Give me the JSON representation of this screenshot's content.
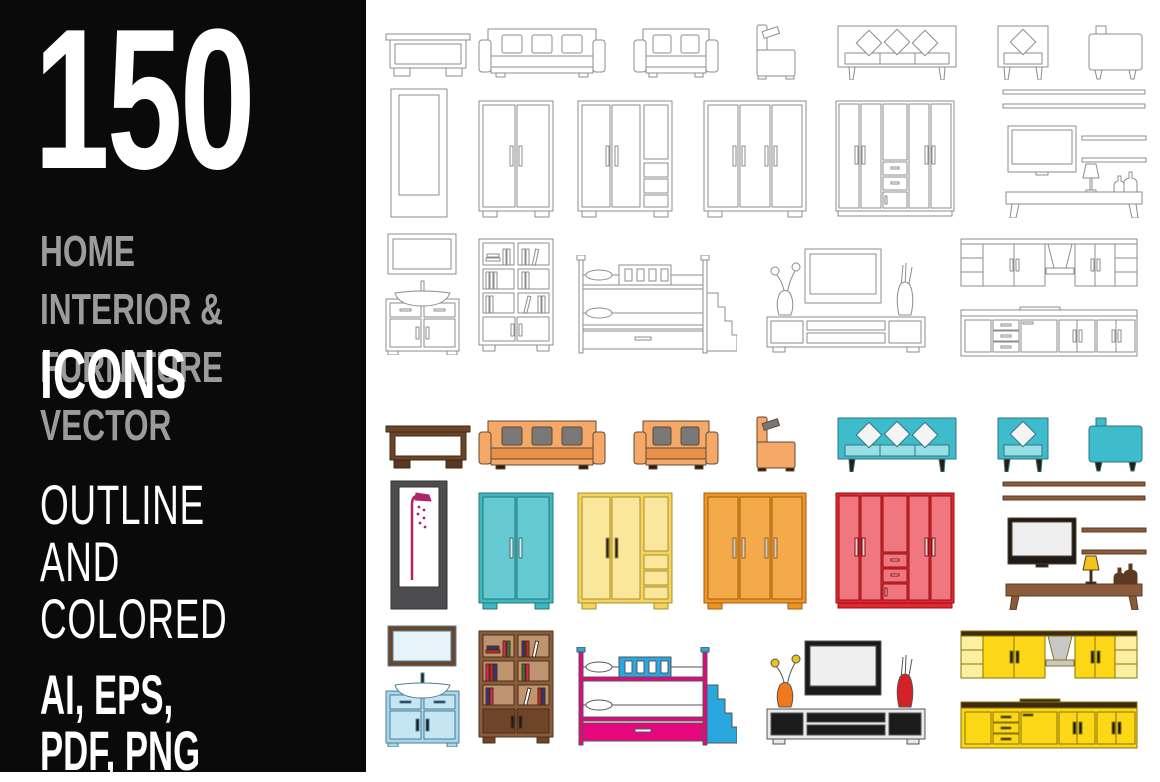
{
  "banner": {
    "count": "150",
    "line1": "HOME INTERIOR &",
    "line2": "FURNITURE VECTOR",
    "line3": "ICONS",
    "sub1": "OUTLINE AND",
    "sub2": "COLORED",
    "formats": "AI, EPS, PDF, PNG",
    "background": "#0a0a0a",
    "gray_text": "#9b9b9b",
    "white_text": "#ffffff"
  },
  "icon_grid": {
    "variants": [
      "outline",
      "colored"
    ],
    "colored_offset_y": 392,
    "icons": [
      {
        "id": "coffee-table",
        "label": "coffee table",
        "x": 385,
        "y": 33,
        "w": 86,
        "h": 45
      },
      {
        "id": "sofa-three-seat",
        "label": "three-seat sofa",
        "x": 478,
        "y": 28,
        "w": 128,
        "h": 50
      },
      {
        "id": "sofa-two-seat",
        "label": "two-seat sofa",
        "x": 633,
        "y": 28,
        "w": 86,
        "h": 50
      },
      {
        "id": "armchair-side",
        "label": "armchair side view",
        "x": 753,
        "y": 24,
        "w": 46,
        "h": 56
      },
      {
        "id": "sofa-diamond-pillows",
        "label": "sofa with diamond pillows",
        "x": 833,
        "y": 25,
        "w": 128,
        "h": 55
      },
      {
        "id": "loveseat-diamond-pillow",
        "label": "armchair with diamond pillow",
        "x": 995,
        "y": 25,
        "w": 56,
        "h": 55
      },
      {
        "id": "club-chair",
        "label": "club chair",
        "x": 1088,
        "y": 25,
        "w": 55,
        "h": 55
      },
      {
        "id": "shower-cabin",
        "label": "shower cabin",
        "x": 390,
        "y": 88,
        "w": 58,
        "h": 130
      },
      {
        "id": "wardrobe-two-door",
        "label": "two-door wardrobe",
        "x": 478,
        "y": 100,
        "w": 76,
        "h": 118
      },
      {
        "id": "wardrobe-with-drawers",
        "label": "wardrobe with shelves and drawers",
        "x": 577,
        "y": 100,
        "w": 96,
        "h": 118
      },
      {
        "id": "wardrobe-three-door",
        "label": "three-door wardrobe",
        "x": 703,
        "y": 100,
        "w": 104,
        "h": 118
      },
      {
        "id": "wardrobe-five-door",
        "label": "five-door wardrobe with drawers",
        "x": 835,
        "y": 100,
        "w": 120,
        "h": 118
      },
      {
        "id": "media-wall-shelves",
        "label": "wall shelves with TV and bench",
        "x": 1000,
        "y": 88,
        "w": 148,
        "h": 130
      },
      {
        "id": "mirror-and-sink-vanity",
        "label": "mirror and sink vanity",
        "x": 385,
        "y": 233,
        "w": 75,
        "h": 122
      },
      {
        "id": "bookshelf",
        "label": "bookshelf with books",
        "x": 478,
        "y": 238,
        "w": 76,
        "h": 115
      },
      {
        "id": "bunk-bed-with-stairs",
        "label": "bunk bed with stairs",
        "x": 575,
        "y": 255,
        "w": 162,
        "h": 100
      },
      {
        "id": "tv-stand-with-vases",
        "label": "TV stand with vases",
        "x": 765,
        "y": 243,
        "w": 162,
        "h": 112
      },
      {
        "id": "kitchen-cabinets",
        "label": "kitchen cabinets",
        "x": 960,
        "y": 238,
        "w": 178,
        "h": 122
      }
    ]
  },
  "palette": {
    "outline_stroke": "#8c8c8c",
    "orange_sofa": "#F5A868",
    "orange_seat": "#E8914A",
    "pillow_gray": "#787878",
    "teal": "#3FBCCB",
    "teal_light": "#9ADEE5",
    "table_brown": "#6E4428",
    "shower_frame": "#4D4D4F",
    "shower_pipe": "#B0246A",
    "wardrobe_teal": "#3FB7C0",
    "wardrobe_yellow": "#F4D45F",
    "wardrobe_orange": "#ED9626",
    "wardrobe_red": "#E62730",
    "wardrobe_red_panel": "#F0777F",
    "wood_brown": "#8A5C3B",
    "wood_tan": "#BE9471",
    "lamp_yellow": "#F5C41A",
    "vanity_blue": "#A9D6EA",
    "vanity_blue_light": "#C6E5F3",
    "bunk_magenta": "#E5077E",
    "bunk_blue": "#29A8E0",
    "vase_orange": "#F07818",
    "vase_red": "#D42027",
    "kitchen_yellow": "#FBD716",
    "kitchen_yellow_light": "#FCF0A0",
    "counter_brown": "#3F2A14",
    "hood_silver": "#C8C8C8",
    "tv_black": "#1B1B1B",
    "screen_gray": "#EFEFEF"
  }
}
